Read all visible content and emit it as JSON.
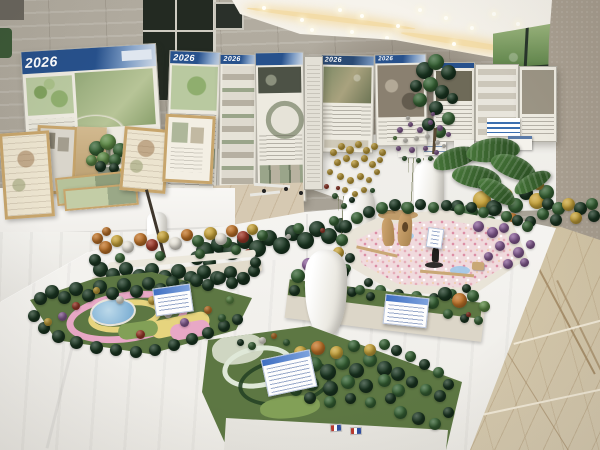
{
  "posters": {
    "year_label": "2026"
  },
  "colors": {
    "wall": "#b3ada1",
    "wall_shade": "#877b6c",
    "ceiling": "#f6f3ec",
    "cove_light": "#f3dca8",
    "door_glass": "#232a22",
    "window_foliage": "#4c7140",
    "column": "#bdb4a5",
    "marble_floor": "#d9cdb2",
    "marble_vein": "#a8906c",
    "tablecloth": "#f6f5f2",
    "cloth_shade": "#dcdad4",
    "poster_bg": "#edeae0",
    "poster_header_blue": "#27518c",
    "poster_header_blue_light": "#7d9cc4",
    "plan_green": "#b9c9a0",
    "plan_green_dark": "#8aa06c",
    "photo_gray": "#8d8776",
    "render_dark": "#4d5246",
    "tree_dk": "#1b3722",
    "tree_md": "#376335",
    "tree_lt": "#5d8a46",
    "tree_yl": "#c9a53b",
    "tree_or": "#c07429",
    "tree_wh": "#e9e5da",
    "tree_pu": "#8a5f98",
    "tree_rd": "#a03a2a",
    "lawn_green": "#5d7743",
    "lawn_light": "#82a057",
    "pond_blue": "#7fb0d4",
    "path_pink": "#e8a8c6",
    "path_yellow": "#e6d47e",
    "plaza_pink": "#f0dadd",
    "wood_tan": "#c9a876",
    "card_white": "#fdfdfd",
    "card_header_blue": "#3f6fc1",
    "vase_white": "#f7f6f2",
    "stick_brown": "#3e362c",
    "frame_wood": "#c7a56c",
    "pot_gray": "#97a08f",
    "leaf_green": "#3f6b33"
  }
}
